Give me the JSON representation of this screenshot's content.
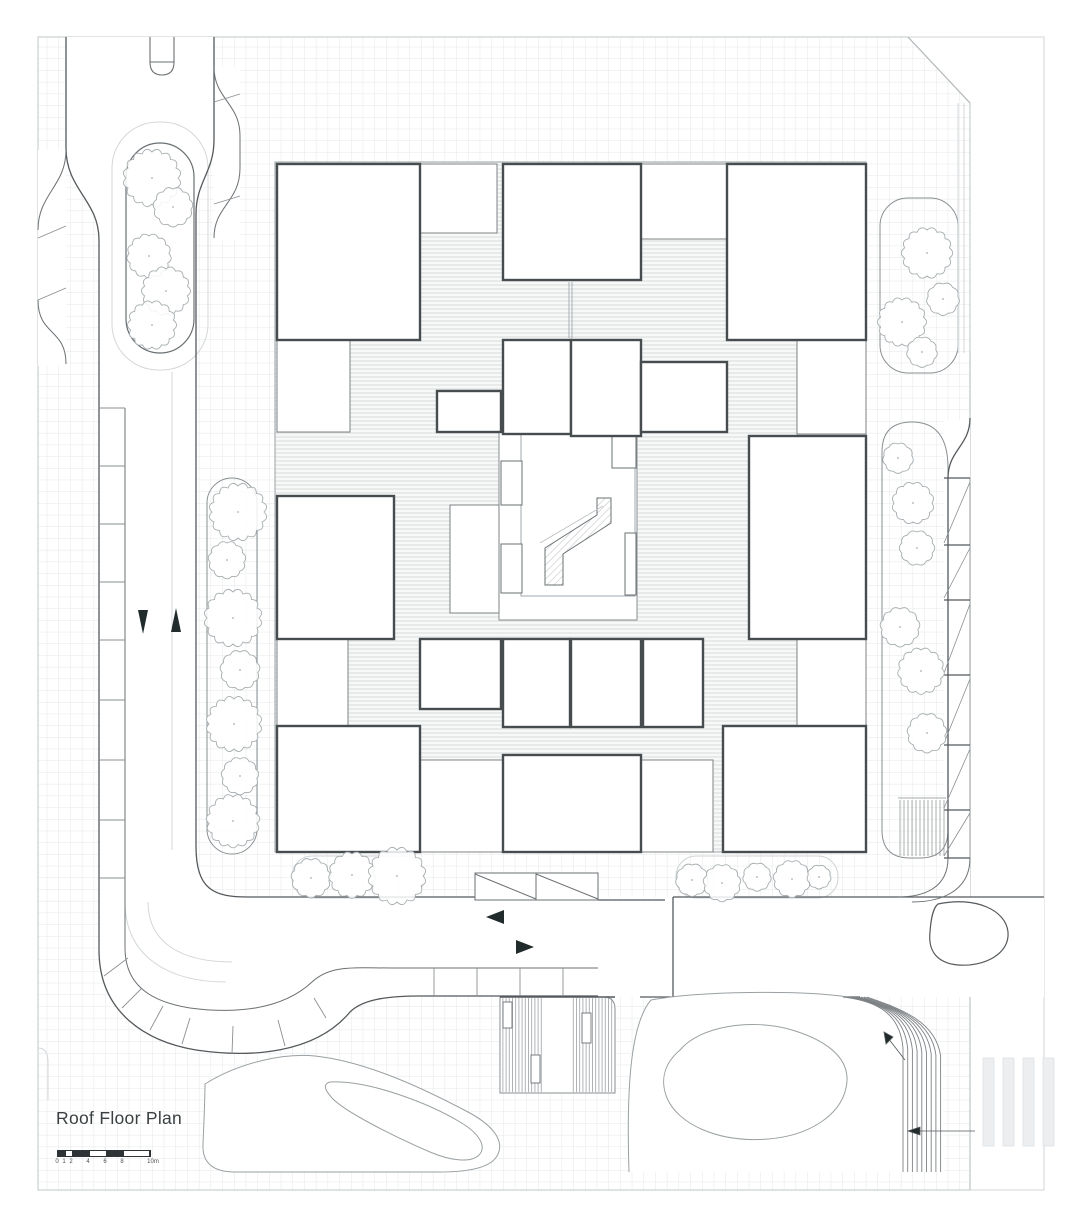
{
  "drawing": {
    "title": "Roof Floor Plan",
    "type_label": "architectural roof plan"
  },
  "scale_bar": {
    "labels": [
      "0",
      "1",
      "2",
      "4",
      "6",
      "8",
      "10m"
    ],
    "unit": "m"
  },
  "annotations": {
    "traffic_arrows": [
      "down",
      "up",
      "left",
      "right"
    ],
    "step_arrows": 2
  },
  "icons": {
    "tree": "tree-scallop-circle",
    "arrow_up": "filled-triangle-up",
    "arrow_down": "filled-triangle-down",
    "arrow_left": "filled-triangle-left",
    "arrow_right": "filled-triangle-right"
  },
  "colors": {
    "paper": "#ffffff",
    "grid_line": "#e4e7e9",
    "hatch_line": "#d8dbdd",
    "kerb_line": "#55595c",
    "building_outline": "#474d4f",
    "thin_line": "#8a8f92",
    "faint_line": "#d3d7d9",
    "tree_stroke": "#a7adb0",
    "arrow_fill": "#212b2b",
    "scale_fill": "#2e3336"
  }
}
